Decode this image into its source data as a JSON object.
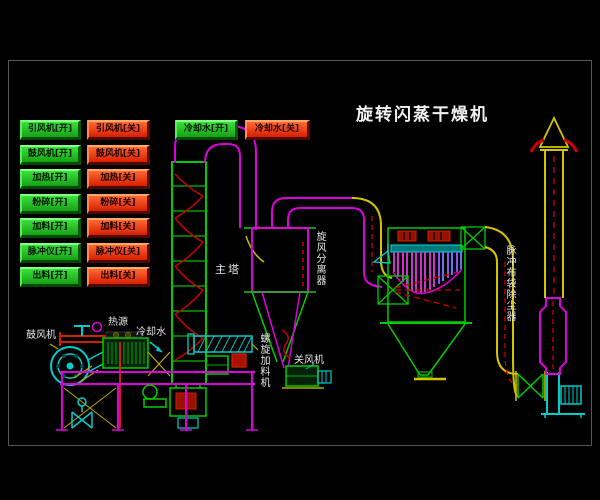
{
  "title": "旋转闪蒸干燥机",
  "control_panel": {
    "buttons": [
      {
        "on": "引风机[开]",
        "off": "引风机[关]"
      },
      {
        "on": "鼓风机[开]",
        "off": "鼓风机[关]"
      },
      {
        "on": "加热[开]",
        "off": "加热[关]"
      },
      {
        "on": "粉碎[开]",
        "off": "粉碎[关]"
      },
      {
        "on": "加料[开]",
        "off": "加料[关]"
      },
      {
        "on": "脉冲仪[开]",
        "off": "脉冲仪[关]"
      },
      {
        "on": "出料[开]",
        "off": "出料[关]"
      }
    ],
    "cooling_water": {
      "on": "冷却水[开]",
      "off": "冷却水[关]"
    }
  },
  "diagram_labels": {
    "main_tower": "主塔",
    "cyclone_separator": "旋风分离器",
    "pulse_bag_dust_collector": "脉冲布袋除尘器",
    "rotary_airlock": "关风机",
    "screw_feeder": "螺旋加料机",
    "heat_source": "热源",
    "cooling_water": "冷却水",
    "blower": "鼓风机"
  },
  "colors": {
    "button_on": "#22c522",
    "button_off": "#e53510",
    "pipe_magenta": "#dd00dd",
    "pipe_yellow": "#d4c400",
    "line_green": "#00cc00",
    "line_cyan": "#00cccc",
    "line_red": "#cc0000",
    "label_text": "#e8e8e8",
    "background": "#000000"
  }
}
